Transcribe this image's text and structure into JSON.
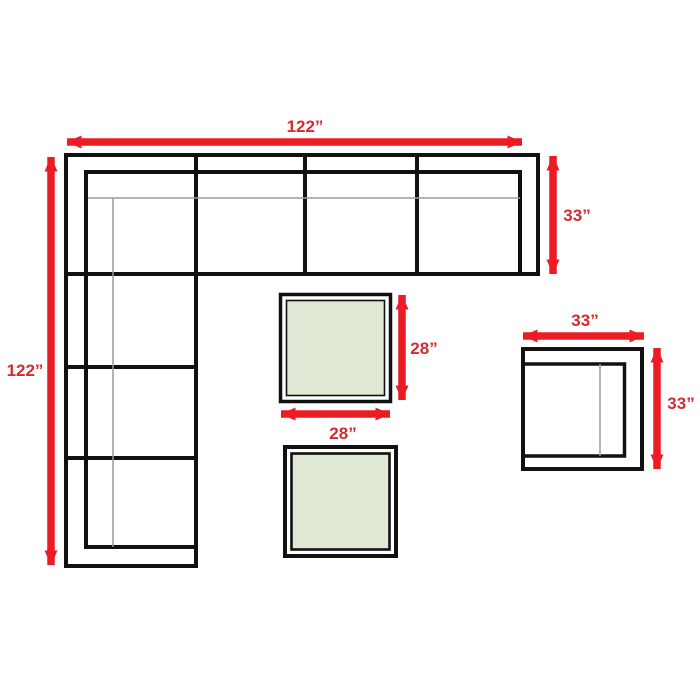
{
  "colors": {
    "background": "#ffffff",
    "arrow_red": "#ec1c24",
    "label_red": "#d52b30",
    "outline_black": "#111111",
    "seam_gray": "#9a9a9a",
    "table_green": "#dee8d4"
  },
  "diagram": {
    "sectional_sofa": {
      "width_label": "122”",
      "height_label": "122”",
      "depth_label": "33”"
    },
    "coffee_table": {
      "height_label": "28”",
      "width_label": "28”"
    },
    "armless_chair": {
      "width_label": "33”",
      "height_label": "33”"
    }
  }
}
